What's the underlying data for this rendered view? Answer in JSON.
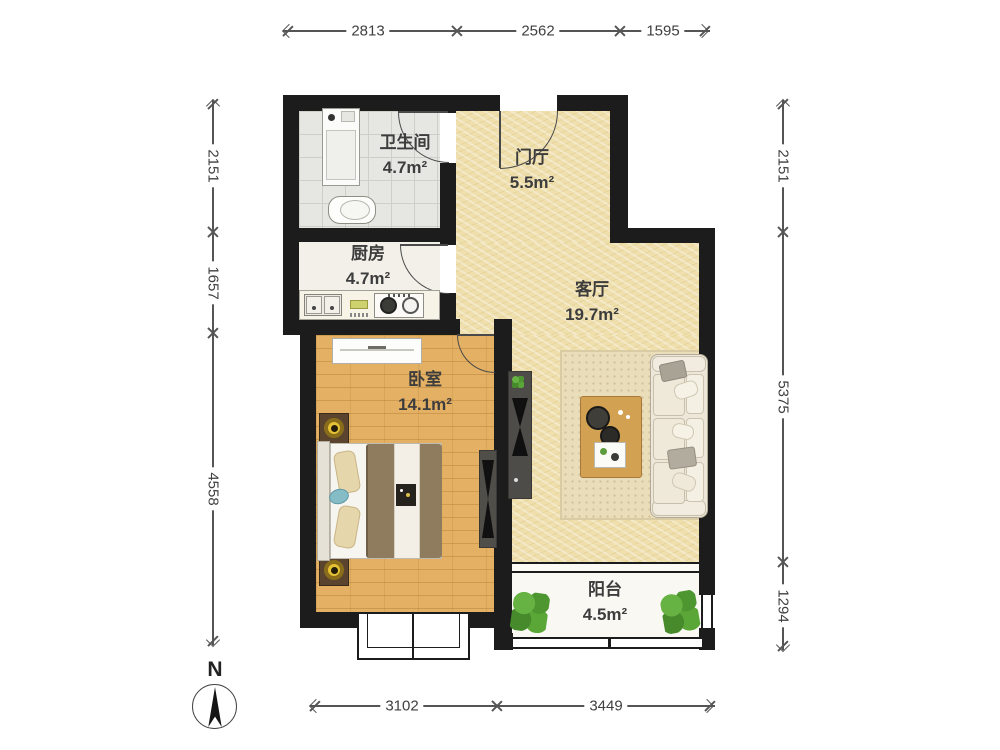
{
  "rooms": [
    {
      "name": "卫生间",
      "area": "4.7m²"
    },
    {
      "name": "门厅",
      "area": "5.5m²"
    },
    {
      "name": "厨房",
      "area": "4.7m²"
    },
    {
      "name": "客厅",
      "area": "19.7m²"
    },
    {
      "name": "卧室",
      "area": "14.1m²"
    },
    {
      "name": "阳台",
      "area": "4.5m²"
    }
  ],
  "dimensions": {
    "top": [
      "2813",
      "2562",
      "1595"
    ],
    "left": [
      "2151",
      "1657",
      "4558"
    ],
    "right": [
      "2151",
      "5375",
      "1294"
    ],
    "bottom": [
      "3102",
      "3449"
    ]
  },
  "compass": {
    "label": "N"
  },
  "colors": {
    "wall": "#1c1c1c",
    "floor_hall_living": "#eedfac",
    "floor_bedroom_wood": "#e4b063",
    "floor_bathroom": "#e6e6e3",
    "floor_kitchen": "#f2f0e9",
    "floor_balcony": "#f9f8f3",
    "plant_green": "#55a033",
    "dimension_text": "#3f3f3f"
  }
}
